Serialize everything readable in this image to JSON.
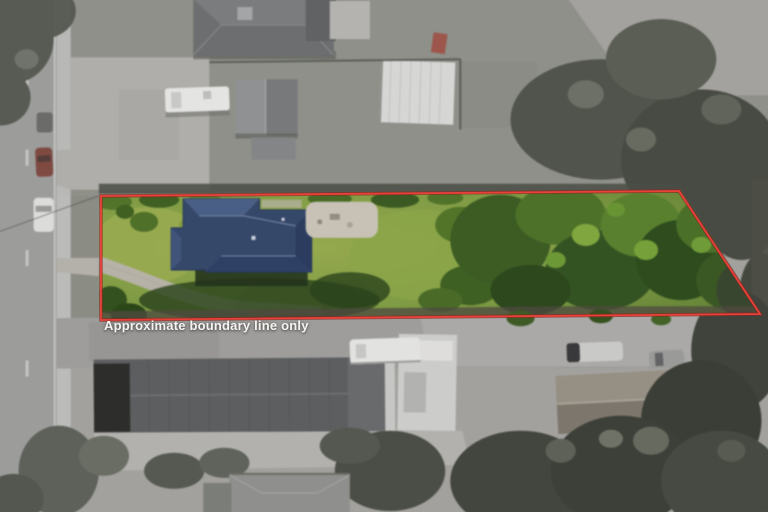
{
  "overlay": {
    "boundary_label": "Approximate boundary line only",
    "boundary_color": "#e8413a",
    "boundary_shadow_color": "#8f231e",
    "label_color": "#f6f4f1"
  },
  "lot": {
    "boundary_points": "101,196 679,191 760,314 101,320",
    "lawn_color": "#7d9a43",
    "house_roof_color": "#36486a"
  }
}
